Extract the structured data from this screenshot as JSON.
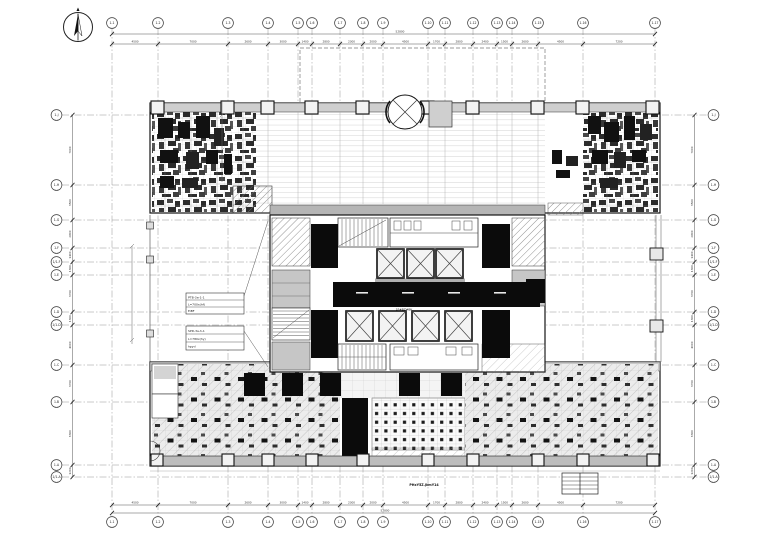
{
  "title": "first-floor-plan",
  "compass": {
    "mark": "N"
  },
  "axes": {
    "columns": [
      {
        "label": "1-1",
        "x": 112
      },
      {
        "label": "1-2",
        "x": 158
      },
      {
        "label": "1-3",
        "x": 228
      },
      {
        "label": "1-4",
        "x": 268
      },
      {
        "label": "1-5",
        "x": 298
      },
      {
        "label": "1-6",
        "x": 312
      },
      {
        "label": "1-7",
        "x": 340
      },
      {
        "label": "1-8",
        "x": 363
      },
      {
        "label": "1-9",
        "x": 383
      },
      {
        "label": "1-10",
        "x": 428
      },
      {
        "label": "1-11",
        "x": 445
      },
      {
        "label": "1-12",
        "x": 473
      },
      {
        "label": "1-13",
        "x": 497
      },
      {
        "label": "1-14",
        "x": 512
      },
      {
        "label": "1-15",
        "x": 538
      },
      {
        "label": "1-16",
        "x": 583
      },
      {
        "label": "1-17",
        "x": 655
      }
    ],
    "rows": [
      {
        "label": "1-J",
        "y": 115
      },
      {
        "label": "1-H",
        "y": 185
      },
      {
        "label": "1-G",
        "y": 220
      },
      {
        "label": "1-F",
        "y": 248
      },
      {
        "label": "1/1-F",
        "y": 262
      },
      {
        "label": "1-E",
        "y": 275
      },
      {
        "label": "1-D",
        "y": 312
      },
      {
        "label": "1/1-D",
        "y": 325
      },
      {
        "label": "1-C",
        "y": 365
      },
      {
        "label": "1-B",
        "y": 402
      },
      {
        "label": "1-A",
        "y": 465
      },
      {
        "label": "1/1-A",
        "y": 477
      }
    ]
  },
  "dimensions": {
    "top_overall": "52800",
    "bottom_overall": "52800",
    "top_segments": [
      "4500",
      "7000",
      "2600",
      "3000",
      "1400",
      "2800",
      "2300",
      "2000",
      "4500",
      "1700",
      "2800",
      "2400",
      "1500",
      "2600",
      "4500",
      "7200"
    ],
    "bottom_segments": [
      "4500",
      "7000",
      "2600",
      "3000",
      "1400",
      "2800",
      "2300",
      "2000",
      "4500",
      "1700",
      "2800",
      "2400",
      "1500",
      "2600",
      "4500",
      "7200"
    ],
    "left_segments": [
      "7000",
      "3500",
      "2800",
      "1400",
      "1300",
      "3700",
      "1300",
      "4000",
      "3700",
      "6300",
      "1200"
    ],
    "right_segments": [
      "7000",
      "3500",
      "2800",
      "1400",
      "1300",
      "3700",
      "1300",
      "4000",
      "3700",
      "6300",
      "1200"
    ]
  },
  "annotations": {
    "table_a": {
      "rows": [
        "PTB-3a-1-1",
        "L=700x(hf)",
        "EiBF"
      ]
    },
    "table_b": {
      "rows": [
        "SPD-3a-h-1",
        "L=780x(hy)",
        "hpyd"
      ]
    },
    "core_label": "1F#BZ#BK",
    "bottom_note": "PHxY5Z.jkmY14"
  },
  "colors": {
    "paper": "#ffffff",
    "ink": "#1a1a1a",
    "wall_gray": "#bdbdbd",
    "light_gray": "#e8e8e8",
    "core_black": "#0b0b0b",
    "hatch_gray": "#7a7a7a",
    "axis_gray": "#8a8a8a"
  }
}
